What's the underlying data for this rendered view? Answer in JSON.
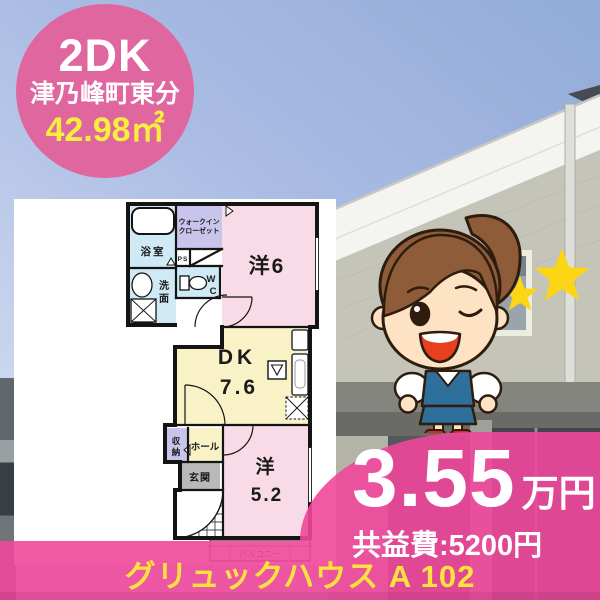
{
  "badge": {
    "layout_type": "2DK",
    "location": "津乃峰町東分",
    "area": "42.98㎡"
  },
  "floorplan": {
    "labels": {
      "bath": "浴室",
      "wic_line1": "ウォークイン",
      "wic_line2": "クローゼット",
      "ps": "PS",
      "wc_line1": "W",
      "wc_line2": "C",
      "wash_line1": "洗",
      "wash_line2": "面",
      "western6": "洋6",
      "dk_line1": "DK",
      "dk_line2": "7.6",
      "storage_line1": "収",
      "storage_line2": "納",
      "hall": "ホール",
      "entrance": "玄関",
      "western52_line1": "洋",
      "western52_line2": "5.2",
      "balcony": "バルコニー"
    }
  },
  "price": {
    "rent_value": "3.55",
    "rent_unit": "万円",
    "fee_label": "共益費:5200円"
  },
  "footer": {
    "property_name": "グリュックハウス A 102"
  },
  "icons": {
    "mascot": "winking-office-lady-mascot",
    "stars": "twin-yellow-stars"
  },
  "colors": {
    "banner_pink": "#f0479b",
    "badge_pink": "#e0669f",
    "footer_yellow": "#ffe23e",
    "area_yellow": "#f8ee3f",
    "room_pink": "#f8dbe7",
    "room_yellow": "#f8f2c6",
    "room_blue": "#cfe9f5",
    "room_purple": "#c9c4ec"
  }
}
